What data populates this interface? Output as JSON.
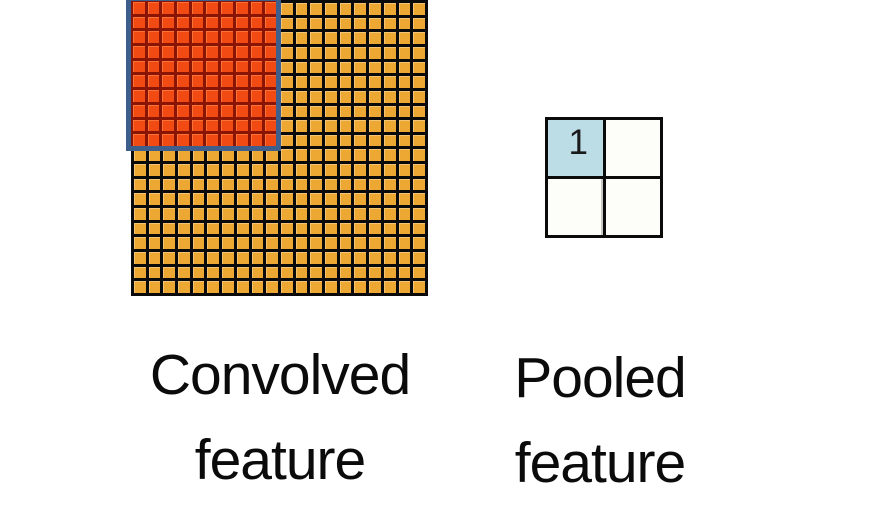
{
  "convolved": {
    "label_line1": "Convolved",
    "label_line2": "feature",
    "grid": {
      "rows": 20,
      "cols": 20,
      "cell_color": "#ECA833",
      "line_color": "#0A0A0A"
    },
    "pooling_window": {
      "rows": 10,
      "cols": 10,
      "cell_color": "#F14B13",
      "line_color": "#8B1504",
      "outline_color": "#3E5E8C"
    }
  },
  "pooled": {
    "label_line1": "Pooled",
    "label_line2": "feature",
    "grid": {
      "rows": 2,
      "cols": 2,
      "values": [
        [
          "1",
          ""
        ],
        [
          "",
          ""
        ]
      ],
      "cell_colors": [
        [
          "#BCDCE6",
          "#FDFDF9"
        ],
        [
          "#FDFDF9",
          "#FDFDF9"
        ]
      ],
      "line_color": "#0B0B0B"
    }
  },
  "text_color": "#0B0B0B"
}
